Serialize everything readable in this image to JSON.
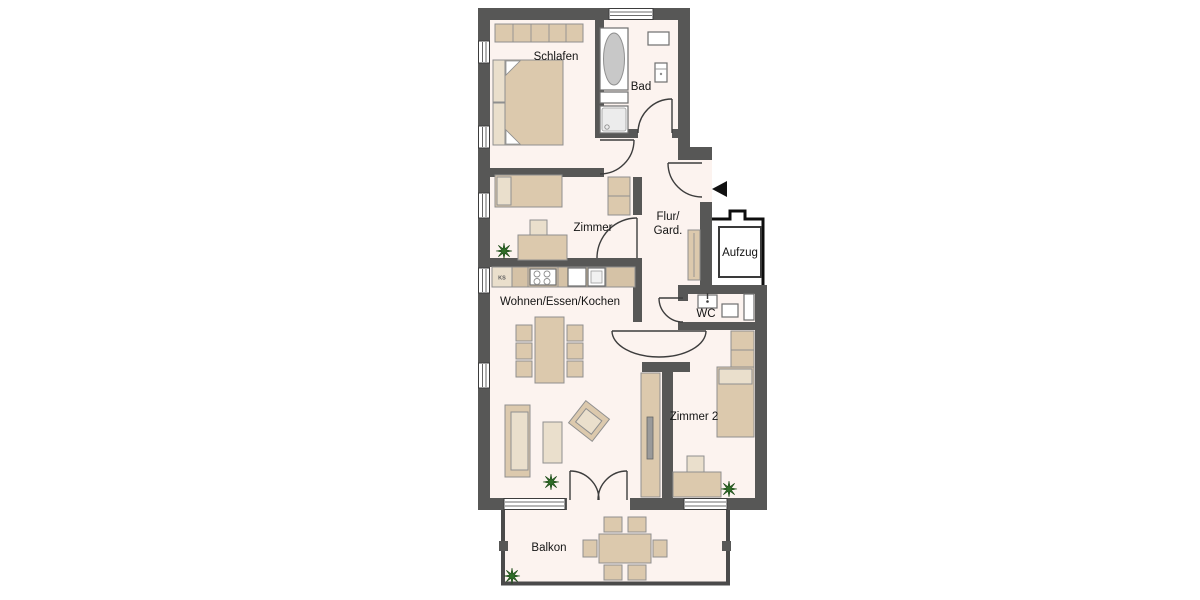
{
  "plan_title": "Apartment floor plan",
  "rooms": {
    "schlafen": {
      "label": "Schlafen"
    },
    "bad": {
      "label": "Bad"
    },
    "zimmer": {
      "label": "Zimmer"
    },
    "flur": {
      "label_line1": "Flur/",
      "label_line2": "Gard."
    },
    "aufzug": {
      "label": "Aufzug"
    },
    "wohnen": {
      "label": "Wohnen/Essen/Kochen"
    },
    "wc": {
      "label": "WC"
    },
    "zimmer2": {
      "label": "Zimmer 2"
    },
    "balkon": {
      "label": "Balkon"
    }
  },
  "kitchen": {
    "fridge_label": "KS"
  },
  "colors": {
    "wall": "#575756",
    "floor": "#fcf3ef",
    "furniture": "#dcc9ad",
    "furniture_light": "#eadfcc",
    "fixture_white": "#ffffff",
    "plant_green": "#2f6d28",
    "door_line": "#3d3d3d",
    "background": "#ffffff"
  }
}
